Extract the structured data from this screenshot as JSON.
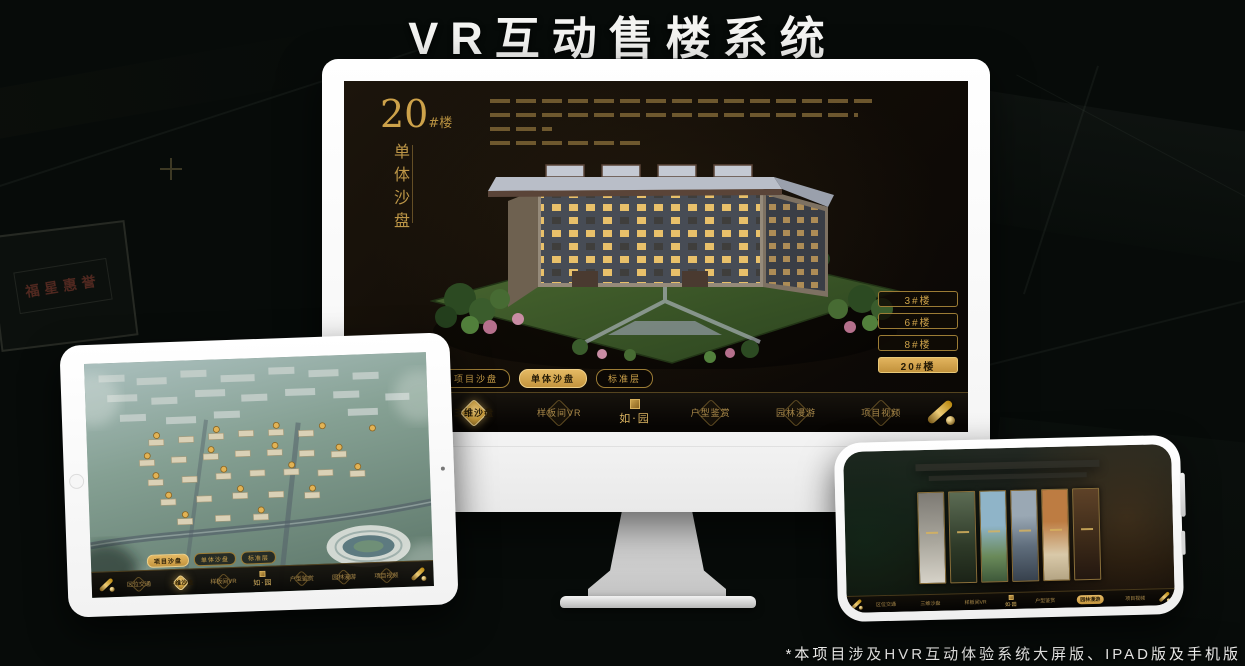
{
  "title": "VR互动售楼系统",
  "footnote": "*本项目涉及HVR互动体验系统大屏版、IPAD版及手机版",
  "brand": {
    "logo_name": "如·园"
  },
  "background": {
    "plaque_text": "福星惠誉"
  },
  "colors": {
    "gold": "#c9a34e",
    "gold_selected": "#d8ac52",
    "screen_dark": "#120d07",
    "frame_white": "#ffffff"
  },
  "monitor": {
    "block_number": "20",
    "block_unit": "#楼",
    "block_subtitle": "单体沙盘",
    "floor_buttons": [
      {
        "label": "3#楼",
        "selected": false
      },
      {
        "label": "6#楼",
        "selected": false
      },
      {
        "label": "8#楼",
        "selected": false
      },
      {
        "label": "20#楼",
        "selected": true
      }
    ],
    "sub_tabs": [
      {
        "label": "项目沙盘",
        "selected": false
      },
      {
        "label": "单体沙盘",
        "selected": true
      },
      {
        "label": "标准层",
        "selected": false
      }
    ],
    "nav_left": [
      {
        "label": "区位交通",
        "selected": false
      },
      {
        "label": "三维沙盘",
        "selected": true
      },
      {
        "label": "样板间VR",
        "selected": false
      }
    ],
    "nav_right": [
      {
        "label": "户型鉴赏",
        "selected": false
      },
      {
        "label": "园林漫游",
        "selected": false
      },
      {
        "label": "项目视频",
        "selected": false
      }
    ]
  },
  "tablet": {
    "sub_tabs": [
      {
        "label": "项目沙盘",
        "selected": true
      },
      {
        "label": "单体沙盘",
        "selected": false
      },
      {
        "label": "标准层",
        "selected": false
      }
    ],
    "nav_left": [
      {
        "label": "区位交通",
        "selected": false
      },
      {
        "label": "三维沙盘",
        "selected": true
      },
      {
        "label": "样板间VR",
        "selected": false
      }
    ],
    "nav_right": [
      {
        "label": "户型鉴赏",
        "selected": false
      },
      {
        "label": "园林漫游",
        "selected": false
      },
      {
        "label": "项目视频",
        "selected": false
      }
    ]
  },
  "phone": {
    "nav_left": [
      {
        "label": "区位交通",
        "selected": false
      },
      {
        "label": "三维沙盘",
        "selected": false
      },
      {
        "label": "样板间VR",
        "selected": false
      }
    ],
    "nav_right": [
      {
        "label": "户型鉴赏",
        "selected": false
      },
      {
        "label": "园林漫游",
        "selected": true
      },
      {
        "label": "项目视频",
        "selected": false
      }
    ]
  }
}
